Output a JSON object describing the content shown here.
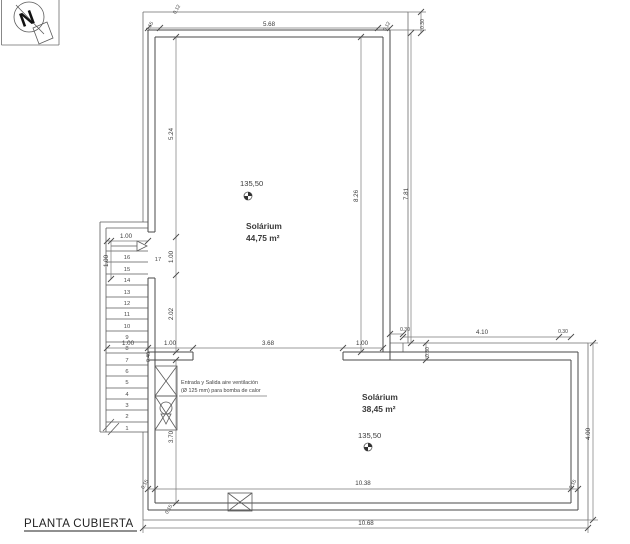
{
  "drawing": {
    "title": "PLANTA CUBIERTA",
    "compass": {
      "label": "N"
    },
    "rooms": {
      "upper": {
        "name": "Solárium",
        "area": "44,75 m²",
        "level": "135,50"
      },
      "lower": {
        "name": "Solárium",
        "area": "38,45 m²",
        "level": "135,50"
      }
    },
    "note": {
      "line1": "Entrada y Salida aire ventilación",
      "line2": "(Ø 125 mm) para bomba de calor"
    },
    "stairs": {
      "top": "17",
      "numbers": [
        "16",
        "15",
        "14",
        "13",
        "12",
        "11",
        "10",
        "9",
        "8",
        "7",
        "6",
        "5",
        "4",
        "3",
        "2",
        "1"
      ]
    },
    "dims": {
      "top_parapet": "0.12",
      "top_left": "0.15",
      "top_width": "5.68",
      "top_right": "0.12",
      "top_right_v": "0.30",
      "left_upper": "5.24",
      "left_mid": "1.00",
      "left_lower": "2.02",
      "inner_height": "8.26",
      "outer_height": "7.81",
      "stair_top_w": "1.00",
      "stair_top_h": "1.00",
      "mid_a": "1.00",
      "mid_b": "1.00",
      "mid_opening": "3.68",
      "mid_c": "1.00",
      "step_h": "0.30",
      "step_v": "0.30",
      "vent_offset": "0.40",
      "right_ext": "4.10",
      "right_ext_end": "0.30",
      "lower_height": "4.00",
      "lower_inner_h": "3.70",
      "bottom_left": "0.15",
      "bottom_width": "10.38",
      "bottom_right": "0.15",
      "bottom_wall": "0.15",
      "total_width": "10.68"
    }
  },
  "colors": {
    "wall": "#4a4a4a",
    "dimension": "#7a7a7a",
    "text": "#3a3a3a",
    "background": "#ffffff"
  }
}
